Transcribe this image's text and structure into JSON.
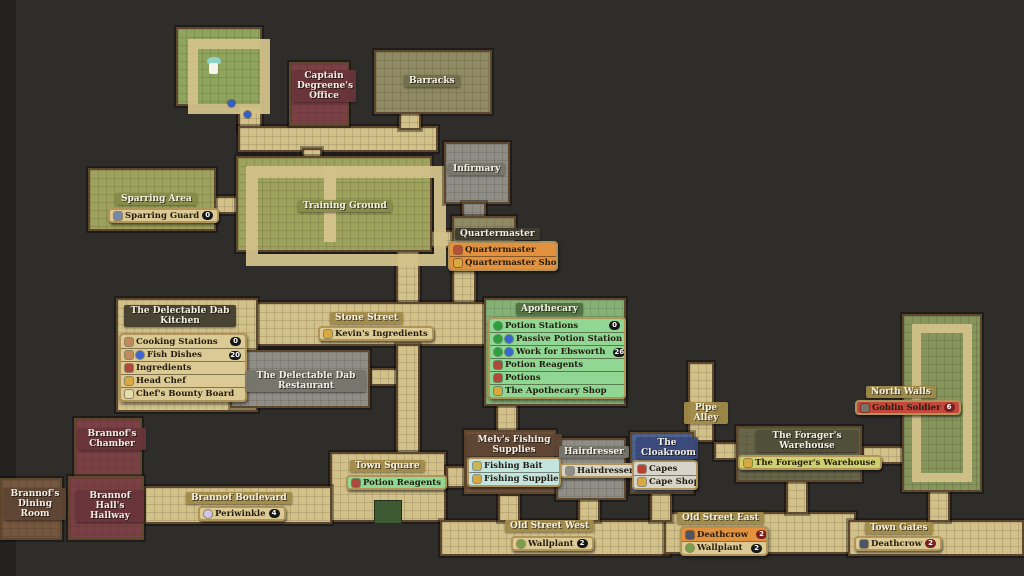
{
  "palette": {
    "bg": "#2e2d2a",
    "bg_edge": "#232220",
    "corridor": "#d2c189",
    "border": "#5e472c",
    "room_green": "#8fa55e",
    "room_olive": "#9da25c",
    "room_khaki": "#8e8a63",
    "room_red": "#7b4045",
    "room_gray": "#8f8e86",
    "room_brown": "#75563f",
    "room_blue": "#4f6598",
    "room_darkolive": "#67664b",
    "room_apogreen": "#85b277",
    "room_wallgreen": "#85955b",
    "planter": "#3e5a35",
    "chip_tan": "#dcca94",
    "chip_orange": "#e2923f",
    "chip_green": "#90d794",
    "chip_cyan": "#c4e4e0",
    "chip_gray": "#d7d5ca",
    "chip_yellowgreen": "#ced06c",
    "chip_red": "#c5473c",
    "badge_black": "#171717",
    "badge_red": "#7c1d1d",
    "marker_blue": "#2f5fd0",
    "player_white": "#f5f4ee",
    "player_teal": "#8fd2c6",
    "icon_bag": "#d9a93f",
    "icon_person": "#b5503c",
    "icon_droplet": "#2f9e3f",
    "icon_orb": "#3a66d4",
    "icon_reagent": "#b0493a",
    "icon_pot": "#c08a5a",
    "icon_paper": "#e6dcae",
    "icon_shield": "#7787a8",
    "icon_scissors": "#8f8f89",
    "icon_cape": "#b8402f",
    "icon_flower": "#cfc6ec",
    "icon_plant": "#79a148",
    "icon_crow": "#4d5566",
    "icon_goblin": "#7a7467",
    "icon_bait": "#cdb457"
  },
  "map": {
    "captain_office": {
      "label": "Captain Degreene's Office"
    },
    "barracks": {
      "label": "Barracks"
    },
    "sparring_area": {
      "label": "Sparring Area",
      "items": [
        {
          "label": "Sparring Guard",
          "badge": "0"
        }
      ]
    },
    "training_ground": {
      "label": "Training Ground"
    },
    "infirmary": {
      "label": "Infirmary"
    },
    "quartermaster": {
      "label": "Quartermaster",
      "items": [
        {
          "label": "Quartermaster"
        },
        {
          "label": "Quartermaster Shop"
        }
      ]
    },
    "stone_street": {
      "label": "Stone Street",
      "items": [
        {
          "label": "Kevin's Ingredients"
        }
      ]
    },
    "kitchen": {
      "label": "The Delectable Dab Kitchen",
      "items": [
        {
          "label": "Cooking Stations",
          "badge": "0"
        },
        {
          "label": "Fish Dishes",
          "badge": "20"
        },
        {
          "label": "Ingredients"
        },
        {
          "label": "Head Chef"
        },
        {
          "label": "Chef's Bounty Board"
        }
      ]
    },
    "restaurant": {
      "label": "The Delectable Dab Restaurant"
    },
    "apothecary": {
      "label": "Apothecary",
      "items": [
        {
          "label": "Potion Stations",
          "badge": "0"
        },
        {
          "label": "Passive Potion Station",
          "badge": "26"
        },
        {
          "label": "Work for Ebsworth",
          "badge": "26"
        },
        {
          "label": "Potion Reagents"
        },
        {
          "label": "Potions"
        },
        {
          "label": "The Apothecary Shop"
        }
      ]
    },
    "brannofs_chamber": {
      "label": "Brannof's Chamber"
    },
    "brannofs_dining_room": {
      "label": "Brannof's Dining Room"
    },
    "brannof_halls_hallway": {
      "label": "Brannof Hall's Hallway"
    },
    "brannof_boulevard": {
      "label": "Brannof Boulevard",
      "items": [
        {
          "label": "Periwinkle",
          "badge": "4"
        }
      ]
    },
    "town_square": {
      "label": "Town Square",
      "items": [
        {
          "label": "Potion Reagents"
        }
      ]
    },
    "melvs": {
      "label": "Melv's Fishing Supplies",
      "items": [
        {
          "label": "Fishing Bait"
        },
        {
          "label": "Fishing Supplies"
        }
      ]
    },
    "hairdresser": {
      "label": "Hairdresser",
      "items": [
        {
          "label": "Hairdresser"
        }
      ]
    },
    "cloakroom": {
      "label": "The Cloakroom",
      "items": [
        {
          "label": "Capes"
        },
        {
          "label": "Cape Shop"
        }
      ]
    },
    "pipe_alley": {
      "label": "Pipe Alley"
    },
    "foragers": {
      "label": "The Forager's Warehouse",
      "items": [
        {
          "label": "The Forager's Warehouse"
        }
      ]
    },
    "north_walls": {
      "label": "North Walls",
      "items": [
        {
          "label": "Goblin Soldier",
          "badge": "6"
        }
      ]
    },
    "old_street_west": {
      "label": "Old Street West",
      "items": [
        {
          "label": "Wallplant",
          "badge": "2"
        }
      ]
    },
    "old_street_east": {
      "label": "Old Street East",
      "items": [
        {
          "label": "Deathcrow",
          "badge": "2"
        },
        {
          "label": "Wallplant",
          "badge": "2"
        }
      ]
    },
    "town_gates": {
      "label": "Town Gates",
      "items": [
        {
          "label": "Deathcrow",
          "badge": "2"
        }
      ]
    }
  }
}
